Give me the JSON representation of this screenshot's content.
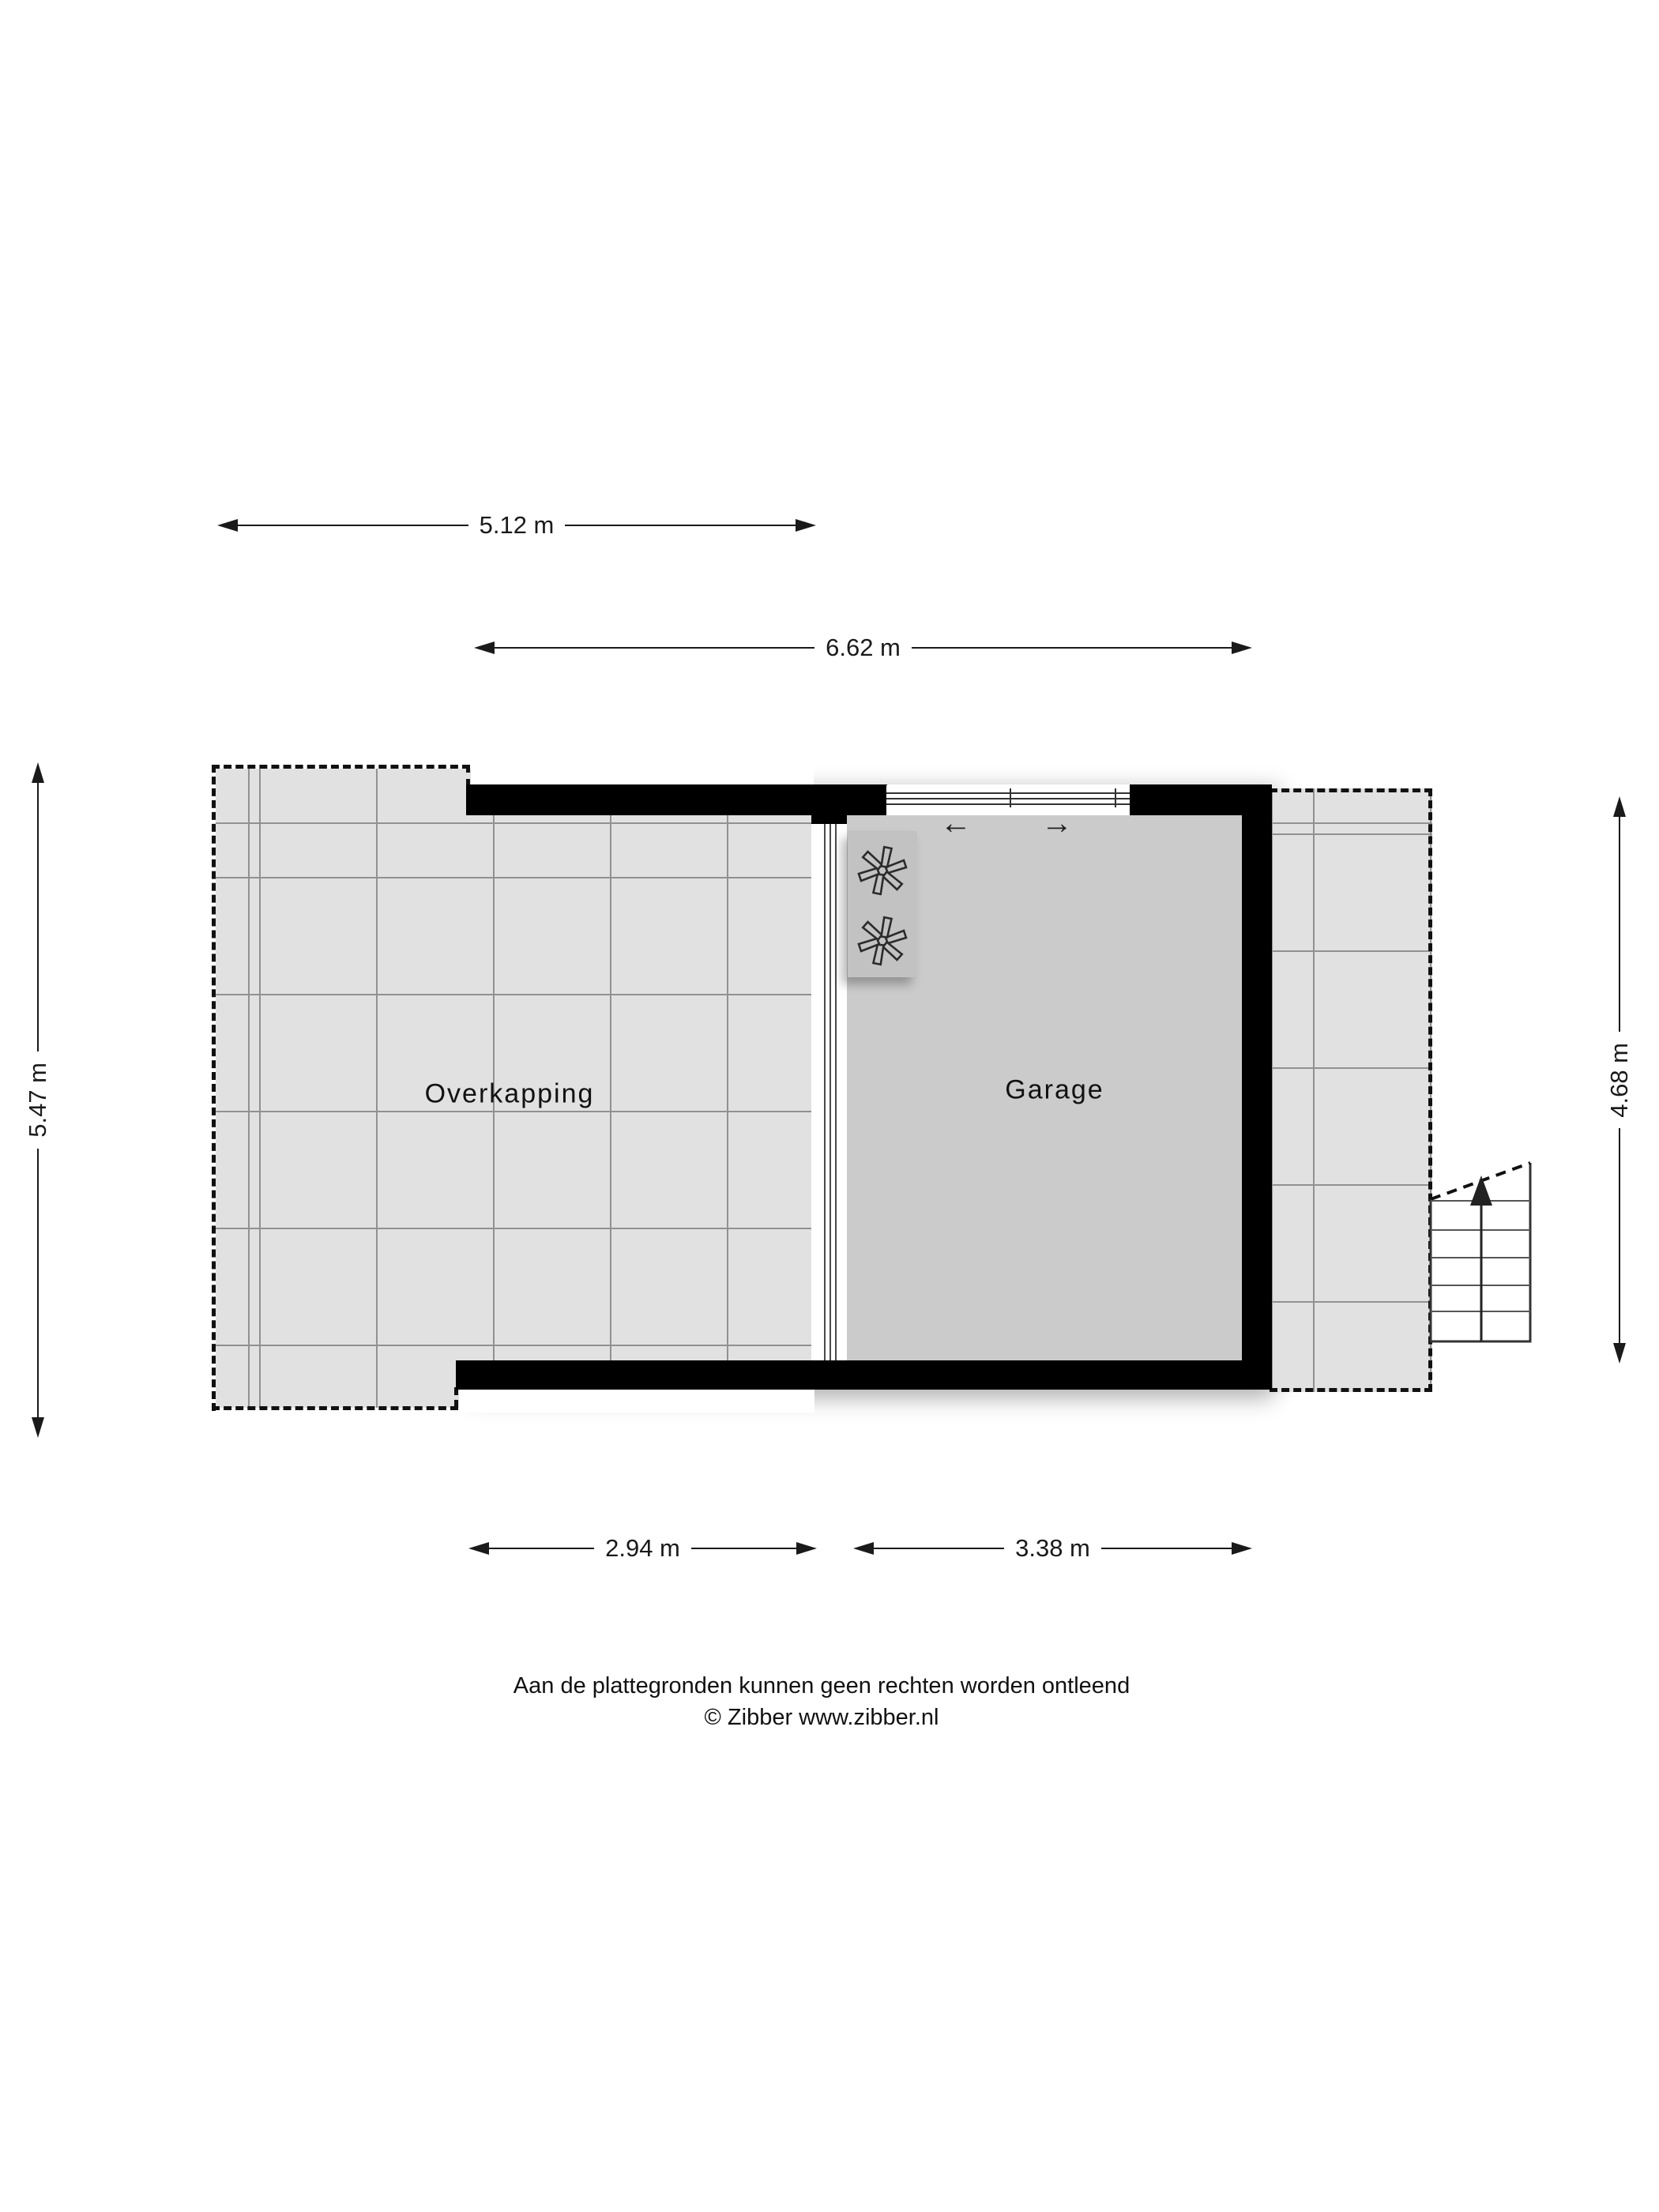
{
  "plan": {
    "type": "floorplan",
    "rooms": {
      "overkapping": {
        "label": "Overkapping"
      },
      "garage": {
        "label": "Garage"
      }
    },
    "dimensions": {
      "top_outer": {
        "label": "5.12 m",
        "side": "top"
      },
      "top_inner": {
        "label": "6.62 m",
        "side": "top"
      },
      "left": {
        "label": "5.47 m",
        "side": "left"
      },
      "right": {
        "label": "4.68 m",
        "side": "right"
      },
      "bottom_left": {
        "label": "2.94 m",
        "side": "bottom"
      },
      "bottom_right": {
        "label": "3.38 m",
        "side": "bottom"
      }
    },
    "garage_door": {
      "type": "sliding-sectional",
      "arrow_left": "←",
      "arrow_right": "→"
    },
    "stairs": {
      "direction": "up",
      "steps": 6
    },
    "icons": [
      "fan-icon",
      "fan-icon",
      "stairs-up-arrow"
    ],
    "colors": {
      "wall": "#000000",
      "tile_floor": "#e1e1e1",
      "garage_floor": "#cbcbcb",
      "grid_line": "#919191",
      "unit_fill": "#c2c2c2",
      "dimension_line": "#1a1a1a"
    }
  },
  "footer": {
    "disclaimer": "Aan de plattegronden kunnen geen rechten worden ontleend",
    "copyright": "© Zibber www.zibber.nl"
  }
}
